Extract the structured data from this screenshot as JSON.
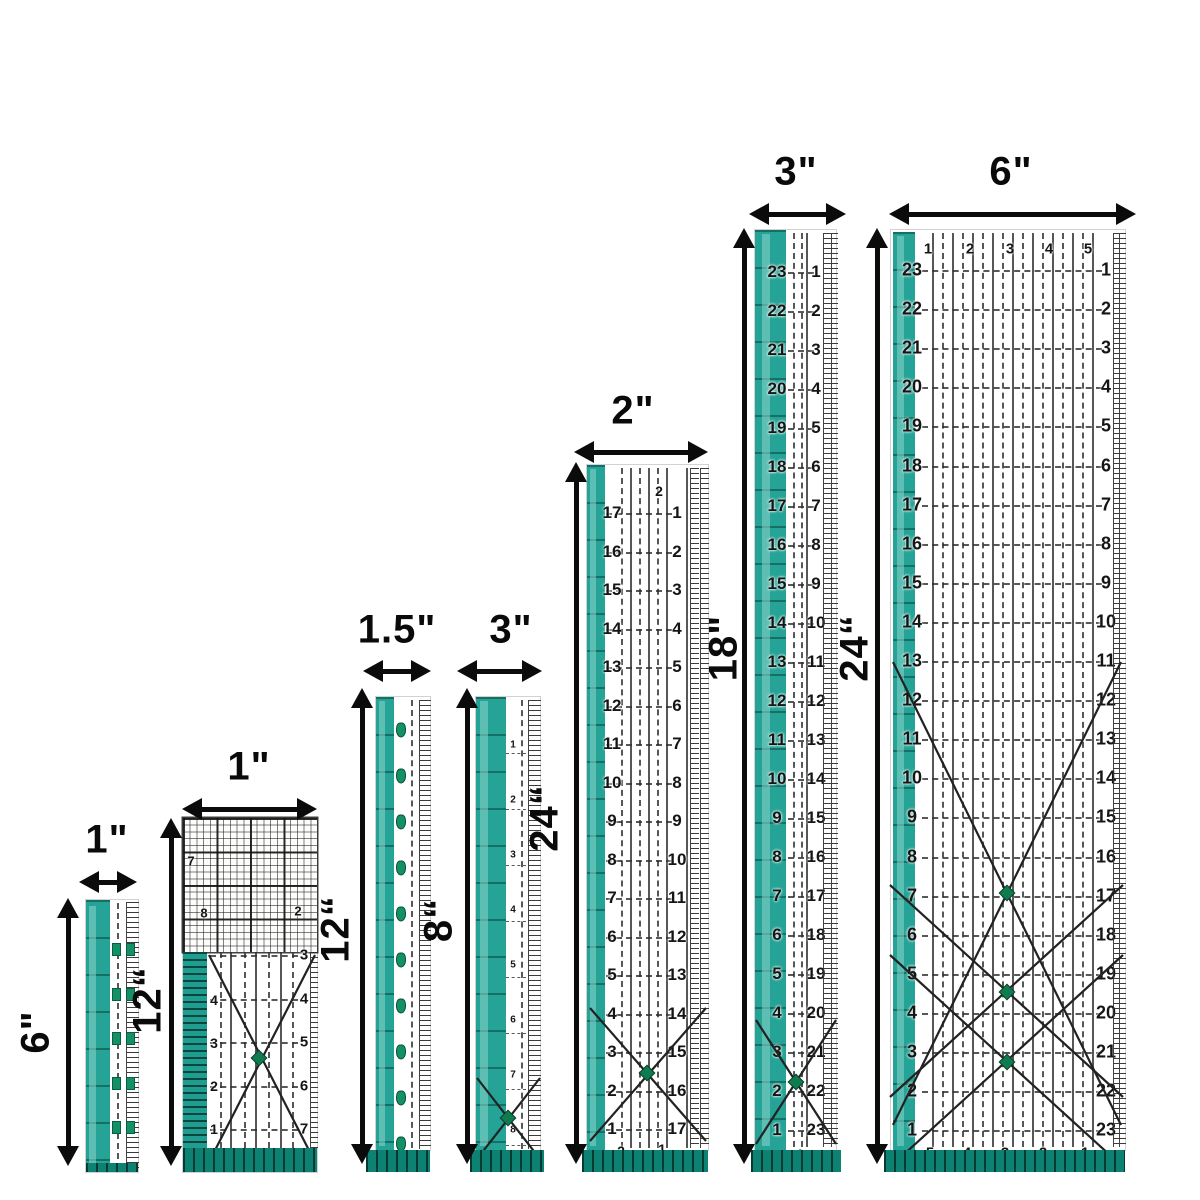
{
  "scene": {
    "w": 1200,
    "h": 1200,
    "bg": "#ffffff",
    "colors": {
      "teal": "#25a396",
      "teal_light": "#6cc6bb",
      "teal_dark": "#0d8273",
      "ink": "#151515",
      "arrow": "#0b0b0b",
      "dot_green": "#0f7b4e"
    }
  },
  "rulers": [
    {
      "name": "ruler-1in-x-6in",
      "width_label": "1\"",
      "height_label": "6\"",
      "h_arrow": {
        "x1": 79,
        "x2": 137,
        "y": 882,
        "lx": 107,
        "ly": 840
      },
      "v_arrow": {
        "x": 68,
        "y1": 898,
        "y2": 1166,
        "lx": 36,
        "ly": 1032
      },
      "layers": [
        {
          "t": "rect",
          "cls": "body",
          "x": 86,
          "y": 900,
          "w": 52,
          "h": 272,
          "name": "ruler-body"
        },
        {
          "t": "rect",
          "cls": "tx-tealseg",
          "x": 86,
          "y": 900,
          "w": 24,
          "h": 272,
          "name": "teal-edge"
        },
        {
          "t": "hl",
          "x": 89,
          "y": 906,
          "w": 7,
          "h": 260
        },
        {
          "t": "stitches",
          "xs": [
            117
          ],
          "y": 903,
          "h": 266
        },
        {
          "t": "fine",
          "x": 126,
          "y": 902,
          "w": 12,
          "h": 268
        },
        {
          "t": "squares",
          "xs": [
            112,
            126
          ],
          "y0": 948,
          "step": 44.5,
          "n": 5
        },
        {
          "t": "rect",
          "cls": "tx-hatch",
          "x": 86,
          "y": 1163,
          "w": 52,
          "h": 9,
          "name": "bottom-edge"
        }
      ]
    },
    {
      "name": "ruler-1in-x-12in",
      "width_label": "1\"",
      "height_label": "12“",
      "h_arrow": {
        "x1": 182,
        "x2": 317,
        "y": 809,
        "lx": 249,
        "ly": 767
      },
      "v_arrow": {
        "x": 171,
        "y1": 818,
        "y2": 1166,
        "lx": 148,
        "ly": 1000
      },
      "layers": [
        {
          "t": "rect",
          "cls": "body",
          "x": 183,
          "y": 818,
          "w": 134,
          "h": 354,
          "name": "ruler-body"
        },
        {
          "t": "rect",
          "cls": "tx-grid",
          "x": 183,
          "y": 818,
          "w": 134,
          "h": 134,
          "name": "grid-section"
        },
        {
          "t": "scatter",
          "size": 13,
          "pts": [
            [
              191,
              861,
              "7"
            ],
            [
              204,
              913,
              "8"
            ],
            [
              298,
              911,
              "2"
            ]
          ]
        },
        {
          "t": "rect",
          "cls": "tx-comb",
          "x": 183,
          "y": 952,
          "w": 24,
          "h": 196,
          "name": "teal-edge"
        },
        {
          "t": "vlines",
          "xs": [
            230,
            255,
            280
          ],
          "y": 952,
          "h": 196
        },
        {
          "t": "stitches",
          "xs": [
            220,
            244,
            268,
            292
          ],
          "y": 952,
          "h": 196
        },
        {
          "t": "hrows",
          "x": 210,
          "w": 88,
          "y0": 955,
          "step": 43.5,
          "n": 5
        },
        {
          "t": "numcol",
          "x": 214,
          "y0": 1000,
          "step": 43,
          "size": 14,
          "vals": [
            "4",
            "3",
            "2",
            "1"
          ]
        },
        {
          "t": "numcol",
          "x": 304,
          "y0": 955,
          "step": 43.5,
          "size": 15,
          "vals": [
            "3",
            "4",
            "5",
            "6",
            "7"
          ]
        },
        {
          "t": "fine",
          "x": 310,
          "y": 952,
          "w": 7,
          "h": 196
        },
        {
          "t": "diag",
          "lines": [
            [
              209,
              955,
              315,
              1162
            ],
            [
              315,
              955,
              209,
              1162
            ]
          ],
          "dots": [
            [
              259,
              1058
            ]
          ]
        },
        {
          "t": "rect",
          "cls": "tx-hatch",
          "x": 183,
          "y": 1148,
          "w": 134,
          "h": 24,
          "name": "bottom-edge"
        }
      ]
    },
    {
      "name": "ruler-1-5in-x-12in",
      "width_label": "1.5\"",
      "height_label": "12“",
      "h_arrow": {
        "x1": 363,
        "x2": 431,
        "y": 671,
        "lx": 397,
        "ly": 630
      },
      "v_arrow": {
        "x": 362,
        "y1": 688,
        "y2": 1164,
        "lx": 336,
        "ly": 929
      },
      "layers": [
        {
          "t": "rect",
          "cls": "body",
          "x": 376,
          "y": 697,
          "w": 54,
          "h": 453,
          "name": "ruler-body"
        },
        {
          "t": "rect",
          "cls": "tx-tealseg",
          "x": 376,
          "y": 697,
          "w": 18,
          "h": 453,
          "name": "teal-edge"
        },
        {
          "t": "hl",
          "x": 379,
          "y": 701,
          "w": 6,
          "h": 445
        },
        {
          "t": "pins",
          "x": 401,
          "y0": 730,
          "step": 46,
          "n": 10
        },
        {
          "t": "stitches",
          "xs": [
            411
          ],
          "y": 700,
          "h": 448
        },
        {
          "t": "fine",
          "x": 419,
          "y": 700,
          "w": 11,
          "h": 449
        },
        {
          "t": "rect",
          "cls": "tx-hatch",
          "x": 366,
          "y": 1150,
          "w": 64,
          "h": 22,
          "name": "bottom-edge"
        }
      ]
    },
    {
      "name": "ruler-3in-x-8in",
      "width_label": "3\"",
      "height_label": "8“",
      "h_arrow": {
        "x1": 457,
        "x2": 542,
        "y": 671,
        "lx": 511,
        "ly": 630
      },
      "v_arrow": {
        "x": 467,
        "y1": 688,
        "y2": 1164,
        "lx": 439,
        "ly": 920
      },
      "layers": [
        {
          "t": "rect",
          "cls": "body",
          "x": 476,
          "y": 697,
          "w": 64,
          "h": 453,
          "name": "ruler-body"
        },
        {
          "t": "rect",
          "cls": "tx-tealseg",
          "x": 476,
          "y": 697,
          "w": 30,
          "h": 453,
          "name": "teal-edge"
        },
        {
          "t": "hl",
          "x": 480,
          "y": 701,
          "w": 8,
          "h": 445
        },
        {
          "t": "numcol",
          "x": 513,
          "y0": 745,
          "step": 55,
          "size": 10,
          "vals": [
            "1",
            "2",
            "3",
            "4",
            "5",
            "6",
            "7",
            "8"
          ]
        },
        {
          "t": "stitches",
          "xs": [
            521
          ],
          "y": 700,
          "h": 449
        },
        {
          "t": "fine",
          "x": 528,
          "y": 700,
          "w": 12,
          "h": 449
        },
        {
          "t": "hrows",
          "x": 506,
          "w": 20,
          "y0": 753,
          "step": 56,
          "n": 8,
          "thin": true
        },
        {
          "t": "diag",
          "lines": [
            [
              477,
              1078,
              540,
              1159
            ],
            [
              540,
              1078,
              477,
              1159
            ]
          ],
          "dots": [
            [
              508,
              1118
            ]
          ]
        },
        {
          "t": "rect",
          "cls": "tx-hatch",
          "x": 470,
          "y": 1150,
          "w": 74,
          "h": 22,
          "name": "bottom-edge"
        }
      ]
    },
    {
      "name": "ruler-2in-x-24in",
      "width_label": "2\"",
      "height_label": "24“",
      "h_arrow": {
        "x1": 574,
        "x2": 708,
        "y": 452,
        "lx": 633,
        "ly": 411
      },
      "v_arrow": {
        "x": 576,
        "y1": 462,
        "y2": 1164,
        "lx": 545,
        "ly": 818
      },
      "layers": [
        {
          "t": "rect",
          "cls": "body",
          "x": 587,
          "y": 465,
          "w": 121,
          "h": 685,
          "name": "ruler-body"
        },
        {
          "t": "rect",
          "cls": "tx-tealseg",
          "x": 587,
          "y": 465,
          "w": 18,
          "h": 685,
          "name": "teal-edge"
        },
        {
          "t": "hl",
          "x": 590,
          "y": 469,
          "w": 6,
          "h": 677
        },
        {
          "t": "vlines",
          "xs": [
            630,
            648,
            666,
            686
          ],
          "y": 468,
          "h": 680
        },
        {
          "t": "stitches",
          "xs": [
            621,
            639,
            657
          ],
          "y": 468,
          "h": 680
        },
        {
          "t": "hrows",
          "x": 606,
          "w": 66,
          "y0": 513,
          "step": 38.5,
          "n": 17
        },
        {
          "t": "numcol",
          "x": 612,
          "y0": 513,
          "step": 38.5,
          "size": 17,
          "vals": [
            "17",
            "16",
            "15",
            "14",
            "13",
            "12",
            "11",
            "10",
            "9",
            "8",
            "7",
            "6",
            "5",
            "4",
            "3",
            "2",
            "1"
          ]
        },
        {
          "t": "numcol",
          "x": 677,
          "y0": 513,
          "step": 38.5,
          "size": 17,
          "vals": [
            "1",
            "2",
            "3",
            "4",
            "5",
            "6",
            "7",
            "8",
            "9",
            "10",
            "11",
            "12",
            "13",
            "14",
            "15",
            "16",
            "17"
          ]
        },
        {
          "t": "scatter",
          "size": 14,
          "pts": [
            [
              659,
              491,
              "2"
            ]
          ]
        },
        {
          "t": "fine",
          "x": 690,
          "y": 468,
          "w": 8,
          "h": 680
        },
        {
          "t": "fine",
          "x": 700,
          "y": 468,
          "w": 8,
          "h": 680
        },
        {
          "t": "diag",
          "lines": [
            [
              590,
              1008,
              706,
              1141
            ],
            [
              706,
              1008,
              590,
              1141
            ]
          ],
          "dots": [
            [
              647,
              1073
            ]
          ]
        },
        {
          "t": "scatter",
          "size": 14,
          "pts": [
            [
              621,
              1151,
              "2"
            ],
            [
              662,
              1149,
              "1"
            ]
          ]
        },
        {
          "t": "rect",
          "cls": "tx-hatch",
          "x": 582,
          "y": 1150,
          "w": 126,
          "h": 22,
          "name": "bottom-edge"
        }
      ]
    },
    {
      "name": "ruler-3in-x-18in",
      "width_label": "3\"",
      "height_label": "18\"",
      "h_arrow": {
        "x1": 749,
        "x2": 846,
        "y": 214,
        "lx": 796,
        "ly": 172
      },
      "v_arrow": {
        "x": 744,
        "y1": 228,
        "y2": 1164,
        "lx": 724,
        "ly": 648
      },
      "layers": [
        {
          "t": "rect",
          "cls": "body",
          "x": 755,
          "y": 230,
          "w": 81,
          "h": 920,
          "name": "ruler-body"
        },
        {
          "t": "rect",
          "cls": "tx-tealseg",
          "x": 755,
          "y": 230,
          "w": 31,
          "h": 920,
          "name": "teal-edge"
        },
        {
          "t": "hl",
          "x": 762,
          "y": 234,
          "w": 8,
          "h": 912
        },
        {
          "t": "stitches",
          "xs": [
            793,
            801
          ],
          "y": 233,
          "h": 914
        },
        {
          "t": "vlines",
          "xs": [
            806
          ],
          "y": 233,
          "h": 914
        },
        {
          "t": "hrows",
          "x": 788,
          "w": 26,
          "y0": 272,
          "step": 39,
          "n": 23
        },
        {
          "t": "numcol",
          "x": 777,
          "y0": 272,
          "step": 39,
          "size": 17,
          "vals": [
            "23",
            "22",
            "21",
            "20",
            "19",
            "18",
            "17",
            "16",
            "15",
            "14",
            "13",
            "12",
            "11",
            "10",
            "9",
            "8",
            "7",
            "6",
            "5",
            "4",
            "3",
            "2",
            "1"
          ]
        },
        {
          "t": "numcol",
          "x": 816,
          "y0": 272,
          "step": 39,
          "size": 17,
          "vals": [
            "1",
            "2",
            "3",
            "4",
            "5",
            "6",
            "7",
            "8",
            "9",
            "10",
            "11",
            "12",
            "13",
            "14",
            "15",
            "16",
            "17",
            "18",
            "19",
            "20",
            "21",
            "22",
            "23"
          ]
        },
        {
          "t": "fine",
          "x": 823,
          "y": 233,
          "w": 7,
          "h": 914
        },
        {
          "t": "fine",
          "x": 831,
          "y": 233,
          "w": 6,
          "h": 914
        },
        {
          "t": "diag",
          "lines": [
            [
              756,
              1020,
              836,
              1144
            ],
            [
              836,
              1020,
              756,
              1144
            ]
          ],
          "dots": [
            [
              796,
              1082
            ]
          ]
        },
        {
          "t": "scatter",
          "size": 14,
          "pts": [
            [
              800,
              1154,
              "1"
            ]
          ]
        },
        {
          "t": "rect",
          "cls": "tx-hatch",
          "x": 751,
          "y": 1150,
          "w": 90,
          "h": 22,
          "name": "bottom-edge"
        }
      ]
    },
    {
      "name": "ruler-6in-x-24in",
      "width_label": "6\"",
      "height_label": "24“",
      "h_arrow": {
        "x1": 889,
        "x2": 1136,
        "y": 214,
        "lx": 1011,
        "ly": 172
      },
      "v_arrow": {
        "x": 877,
        "y1": 228,
        "y2": 1164,
        "lx": 855,
        "ly": 648
      },
      "layers": [
        {
          "t": "rect",
          "cls": "body",
          "x": 891,
          "y": 230,
          "w": 234,
          "h": 920,
          "name": "ruler-body"
        },
        {
          "t": "rect",
          "cls": "tx-tealseg",
          "x": 893,
          "y": 232,
          "w": 22,
          "h": 918,
          "name": "teal-edge"
        },
        {
          "t": "hl",
          "x": 897,
          "y": 236,
          "w": 7,
          "h": 910
        },
        {
          "t": "vlines",
          "xs": [
            932,
            952,
            972,
            992,
            1012,
            1032,
            1052,
            1072,
            1092
          ],
          "y": 233,
          "h": 914
        },
        {
          "t": "stitches",
          "xs": [
            942,
            962,
            982,
            1002,
            1022,
            1042,
            1062,
            1082
          ],
          "y": 233,
          "h": 914
        },
        {
          "t": "hrows",
          "x": 922,
          "w": 180,
          "y0": 270,
          "step": 39.1,
          "n": 23
        },
        {
          "t": "numcol",
          "x": 912,
          "y0": 270,
          "step": 39.1,
          "size": 18,
          "vals": [
            "23",
            "22",
            "21",
            "20",
            "19",
            "18",
            "17",
            "16",
            "15",
            "14",
            "13",
            "12",
            "11",
            "10",
            "9",
            "8",
            "7",
            "6",
            "5",
            "4",
            "3",
            "2",
            "1"
          ]
        },
        {
          "t": "numcol",
          "x": 1106,
          "y0": 270,
          "step": 39.1,
          "size": 18,
          "vals": [
            "1",
            "2",
            "3",
            "4",
            "5",
            "6",
            "7",
            "8",
            "9",
            "10",
            "11",
            "12",
            "13",
            "14",
            "15",
            "16",
            "17",
            "18",
            "19",
            "20",
            "21",
            "22",
            "23"
          ]
        },
        {
          "t": "numrow",
          "y": 249,
          "xs": [
            928,
            970,
            1010,
            1049,
            1088
          ],
          "size": 15,
          "vals": [
            "1",
            "2",
            "3",
            "4",
            "5"
          ]
        },
        {
          "t": "numrow",
          "y": 1153,
          "xs": [
            930,
            967,
            1005,
            1043,
            1085
          ],
          "size": 15,
          "vals": [
            "5",
            "4",
            "3",
            "2",
            "1"
          ]
        },
        {
          "t": "fine",
          "x": 1113,
          "y": 233,
          "w": 5,
          "h": 914
        },
        {
          "t": "fine",
          "x": 1119,
          "y": 233,
          "w": 6,
          "h": 914
        },
        {
          "t": "diag",
          "lines": [
            [
              893,
              662,
              1121,
              1125
            ],
            [
              1121,
              662,
              893,
              1125
            ],
            [
              890,
              885,
              1123,
              1097
            ],
            [
              1123,
              885,
              890,
              1097
            ],
            [
              890,
              955,
              1123,
              1167
            ],
            [
              1123,
              955,
              890,
              1167
            ]
          ],
          "dots": [
            [
              1007,
              893
            ],
            [
              1007,
              992
            ],
            [
              1007,
              1062
            ]
          ]
        },
        {
          "t": "rect",
          "cls": "tx-hatch",
          "x": 884,
          "y": 1150,
          "w": 241,
          "h": 22,
          "name": "bottom-edge"
        }
      ]
    }
  ]
}
